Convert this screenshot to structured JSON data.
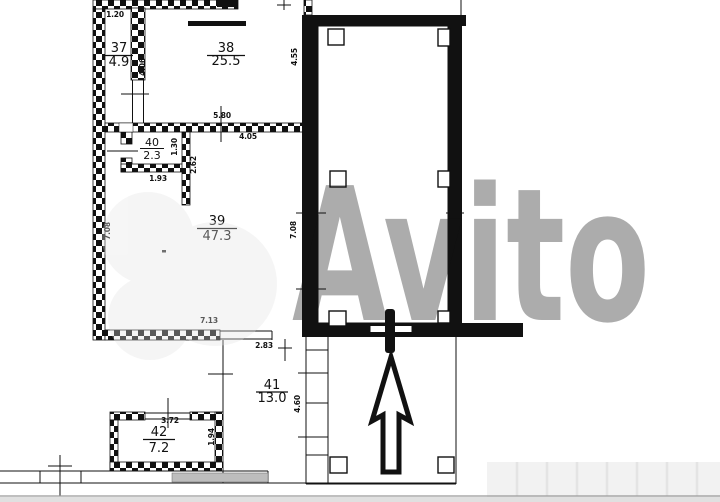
{
  "plan": {
    "rooms": {
      "r37": {
        "number": "37",
        "area": "4.9"
      },
      "r38": {
        "number": "38",
        "area": "25.5"
      },
      "r39": {
        "number": "39",
        "area": "47.3"
      },
      "r40": {
        "number": "40",
        "area": "2.3"
      },
      "r41": {
        "number": "41",
        "area": "13.0"
      },
      "r42": {
        "number": "42",
        "area": "7.2"
      }
    },
    "dimensions": {
      "room37_width": "1.20",
      "room37_height": "4.06",
      "room38_width": "5.80",
      "room39_top_width": "4.05",
      "hall_upper_height": "4.55",
      "room40_height": "1.30",
      "room40_width": "1.93",
      "room40_wall_stub": "2.62",
      "room39_height_left": "7.08",
      "hall_lower_height": "7.08",
      "room39_width": "7.13",
      "room39_door_width": "2.83",
      "room41_height": "4.60",
      "room42_width": "3.72",
      "room42_height": "1.94"
    },
    "colors": {
      "wall_black": "#111111",
      "background": "#ffffff",
      "gray_band": "#bdbdbd",
      "faint_band": "#f2f2f2"
    }
  },
  "watermark": {
    "text": "Avito"
  }
}
